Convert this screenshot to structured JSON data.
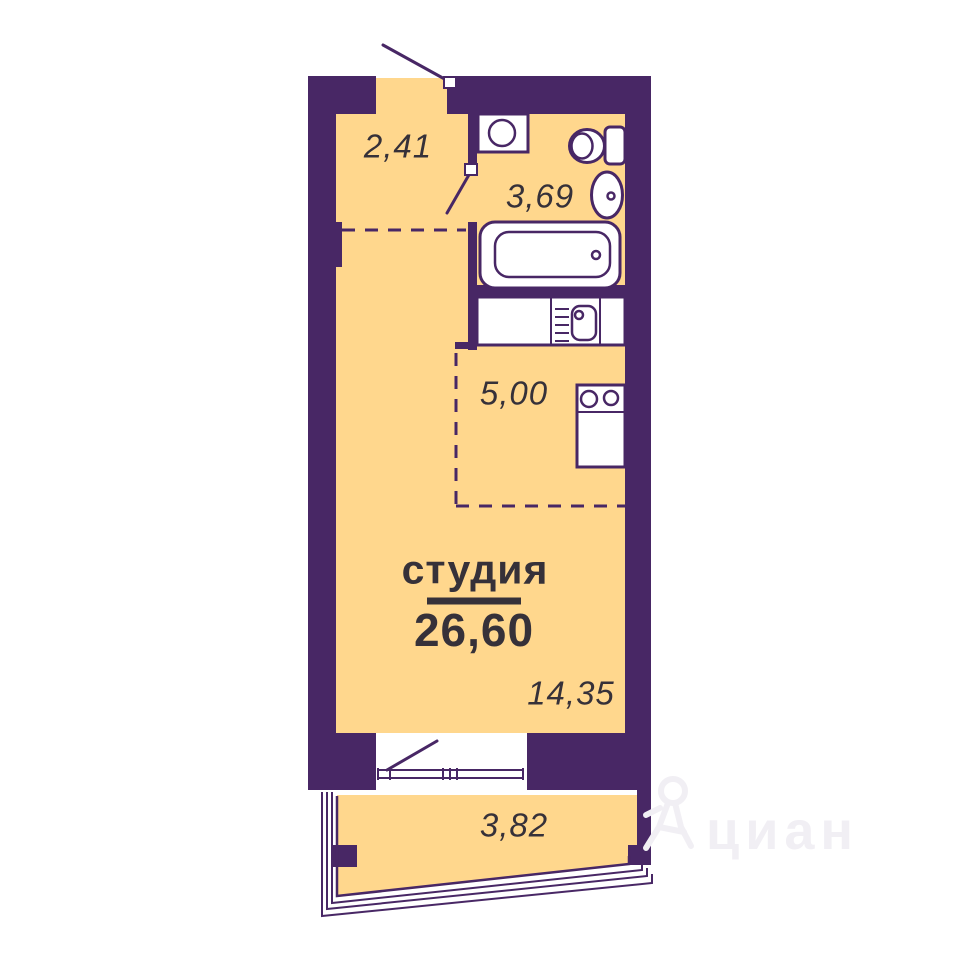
{
  "plan": {
    "title": "студия",
    "total_area": "26,60",
    "rooms": {
      "hall": {
        "area": "2,41"
      },
      "bathroom": {
        "area": "3,69"
      },
      "kitchen": {
        "area": "5,00"
      },
      "living": {
        "area": "14,35"
      },
      "balcony": {
        "area": "3,82"
      }
    }
  },
  "watermark": {
    "text": "циан"
  },
  "colors": {
    "wall": "#482765",
    "room": "#FFD78D",
    "text": "#363139",
    "watermark": "#F1EFF4",
    "white": "#FFFFFF"
  }
}
